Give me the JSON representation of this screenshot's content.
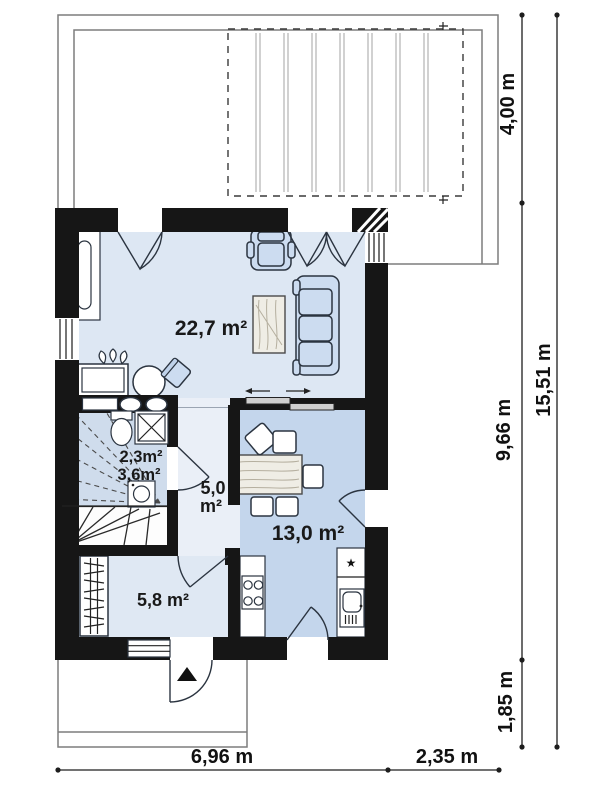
{
  "drawing_title": "house-ground-floor-plan",
  "colors": {
    "wall": "#161616",
    "living_floor": "#dde7f3",
    "kitchen_floor": "#c4d6ec",
    "bath_floor": "#cfdcec",
    "hall_floor": "#eaeff7",
    "vestibule_floor": "#dfe8f3",
    "stairs_floor": "#fdfdfd",
    "furniture_fill": "#ccdcf0",
    "outline_gray": "#7d7d7d"
  },
  "rooms": {
    "living": {
      "label": "22,7 m²"
    },
    "wc": {
      "label": "2,3m²"
    },
    "bath": {
      "label": "3,6m²"
    },
    "hall": {
      "label_value": "5,0",
      "label_unit": "m²"
    },
    "kitchen": {
      "label": "13,0 m²"
    },
    "vestibule": {
      "label": "5,8 m²"
    }
  },
  "dimensions": {
    "terrace_depth": "4,00 m",
    "house_depth": "9,66 m",
    "porch_depth": "1,85 m",
    "total_depth": "15,51 m",
    "house_width": "6,96 m",
    "terrace_side_width": "2,35 m"
  },
  "symbols": {
    "fridge_star": "★"
  }
}
